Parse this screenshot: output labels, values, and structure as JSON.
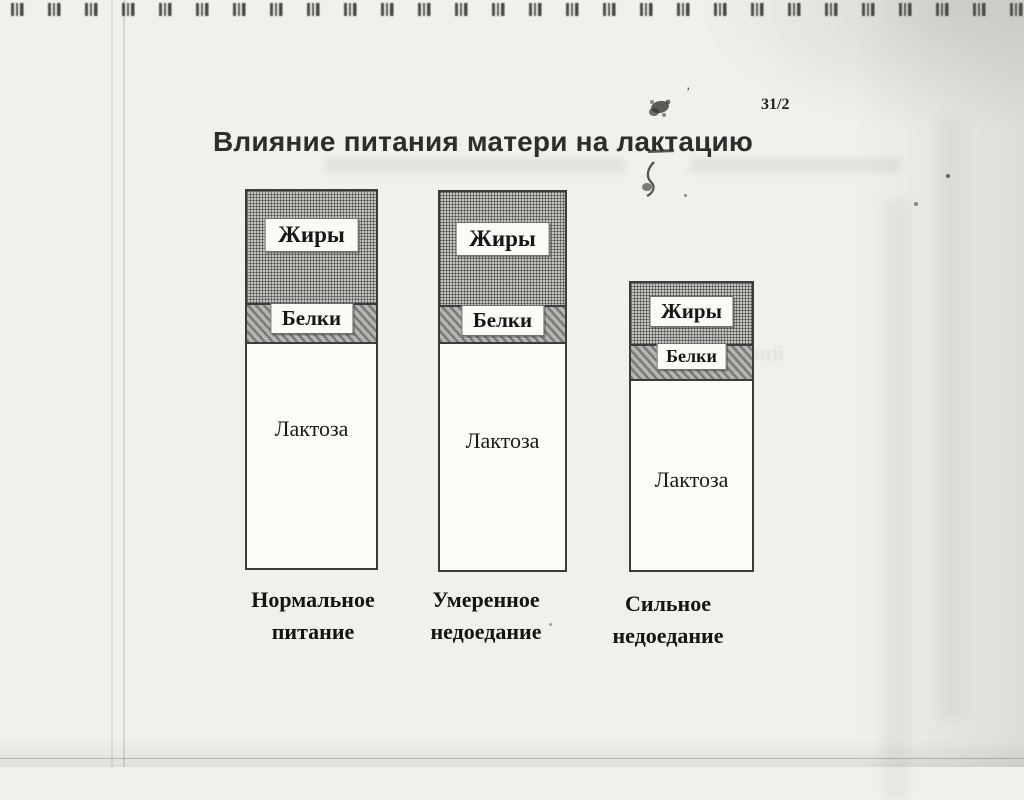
{
  "page": {
    "slide_number": "31/2",
    "title": "Влияние питания матери на лактацию"
  },
  "chart_data": {
    "type": "bar",
    "variant": "stacked-columns-qualitative-diagram",
    "title": "Влияние питания матери на лактацию",
    "categories": [
      "Нормальное питание",
      "Умеренное недоедание",
      "Сильное недоедание"
    ],
    "series": [
      {
        "name": "Жиры",
        "fill": "cross-hatch-gray",
        "values_px": [
          114,
          115,
          63
        ]
      },
      {
        "name": "Белки",
        "fill": "diagonal-hatch-gray",
        "values_px": [
          39,
          37,
          35
        ]
      },
      {
        "name": "Лактоза",
        "fill": "white",
        "values_px": [
          228,
          230,
          193
        ]
      }
    ],
    "column_total_heights_px": [
      381,
      382,
      291
    ],
    "axes": "none",
    "gridlines": false,
    "legend": "labels printed inside segments"
  },
  "columns": [
    {
      "fats_label": "Жиры",
      "proteins_label": "Белки",
      "lactose_label": "Лактоза",
      "caption_line1": "Нормальное",
      "caption_line2": "питание"
    },
    {
      "fats_label": "Жиры",
      "proteins_label": "Белки",
      "lactose_label": "Лактоза",
      "caption_line1": "Умеренное",
      "caption_line2": "недоедание"
    },
    {
      "fats_label": "Жиры",
      "proteins_label": "Белки",
      "lactose_label": "Лактоза",
      "caption_line1": "Сильное",
      "caption_line2": "недоедание"
    }
  ],
  "scan_artifacts": {
    "ghost_fragments": {
      "g1": "фасоли",
      "g2": "банана",
      "g3": "масла",
      "g4": "калорий"
    }
  },
  "colors": {
    "paper": "#f1f0ea",
    "bar_border": "#3b3b3b",
    "fats_hatch": "#c4c3bf",
    "proteins_hatch": "#b6b5b1",
    "text": "#141414"
  }
}
